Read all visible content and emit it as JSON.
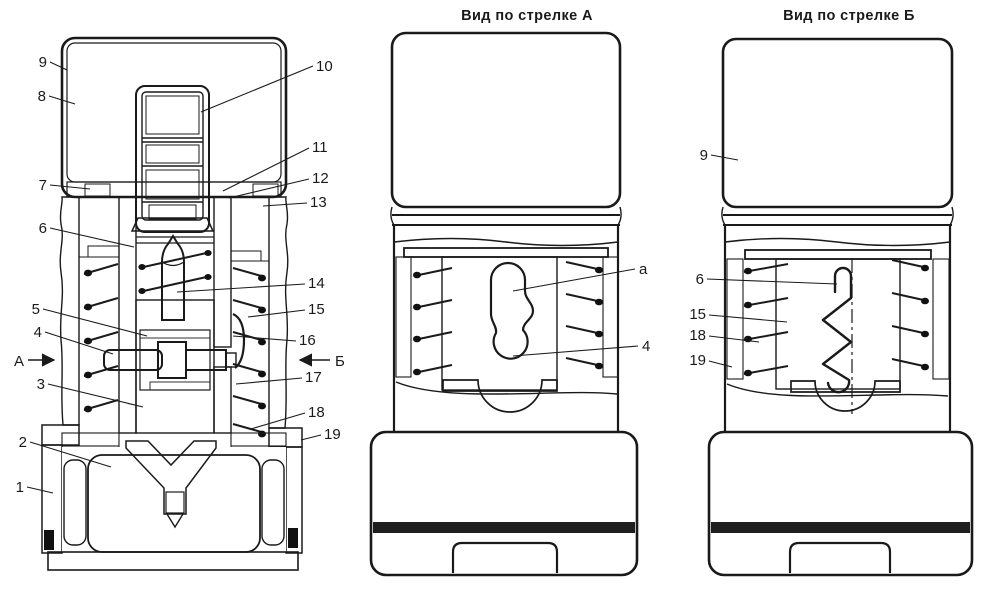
{
  "figure": {
    "kind": "technical cross-section drawing, fuze mechanism, three views",
    "colors": {
      "ink": "#1a1a1a",
      "paper": "#ffffff"
    },
    "main_view": {
      "left_callouts": [
        "9",
        "8",
        "7",
        "6",
        "5",
        "4",
        "3",
        "2",
        "1"
      ],
      "right_callouts": [
        "10",
        "11",
        "12",
        "13",
        "14",
        "15",
        "16",
        "17",
        "18",
        "19"
      ],
      "arrow_left_label": "А",
      "arrow_right_label": "Б"
    },
    "view_a": {
      "title": "Вид по стрелке А",
      "callouts": [
        "а",
        "4"
      ]
    },
    "view_b": {
      "title": "Вид по стрелке Б",
      "callouts": [
        "9",
        "6",
        "15",
        "18",
        "19"
      ]
    }
  }
}
